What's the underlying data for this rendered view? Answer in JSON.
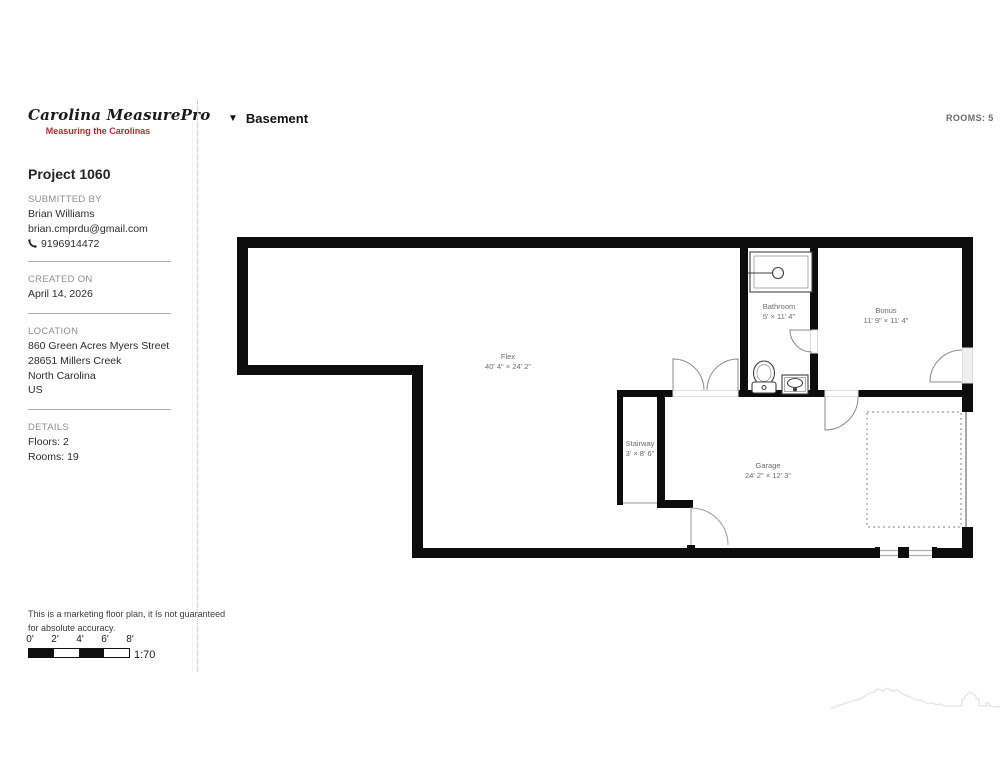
{
  "branding": {
    "logo": "Carolina MeasurePro",
    "tagline": "Measuring the Carolinas",
    "tagline_color": "#b0302e"
  },
  "project": {
    "title": "Project 1060",
    "submitted_by": {
      "label": "SUBMITTED BY",
      "name": "Brian Williams",
      "email": "brian.cmprdu@gmail.com",
      "phone": "9196914472"
    },
    "created_on": {
      "label": "CREATED ON",
      "date": "April 14, 2026"
    },
    "location": {
      "label": "LOCATION",
      "lines": [
        "860 Green Acres Myers Street",
        "28651 Millers Creek",
        "North Carolina",
        "US"
      ]
    },
    "details": {
      "label": "DETAILS",
      "floors": "Floors: 2",
      "rooms": "Rooms: 19"
    }
  },
  "header": {
    "floor_name": "Basement",
    "rooms_badge": "ROOMS: 5",
    "collapse_icon": "▼"
  },
  "floor_plan": {
    "wall_color": "#0d0d0d",
    "rooms": [
      {
        "name": "Flex",
        "dims": "40' 4\" × 24' 2\""
      },
      {
        "name": "Bathroom",
        "dims": "5' × 11' 4\""
      },
      {
        "name": "Bonus",
        "dims": "11' 9\" × 11' 4\""
      },
      {
        "name": "Stairway",
        "dims": "3' × 8' 6\""
      },
      {
        "name": "Garage",
        "dims": "24' 2\" × 12' 3\""
      }
    ]
  },
  "footer": {
    "disclaimer_line1": "This is a marketing floor plan, it Is not guaranteed",
    "disclaimer_line2": "for absolute accuracy.",
    "scale": {
      "ticks": [
        "0'",
        "2'",
        "4'",
        "6'",
        "8'"
      ],
      "ratio": "1:70"
    }
  }
}
